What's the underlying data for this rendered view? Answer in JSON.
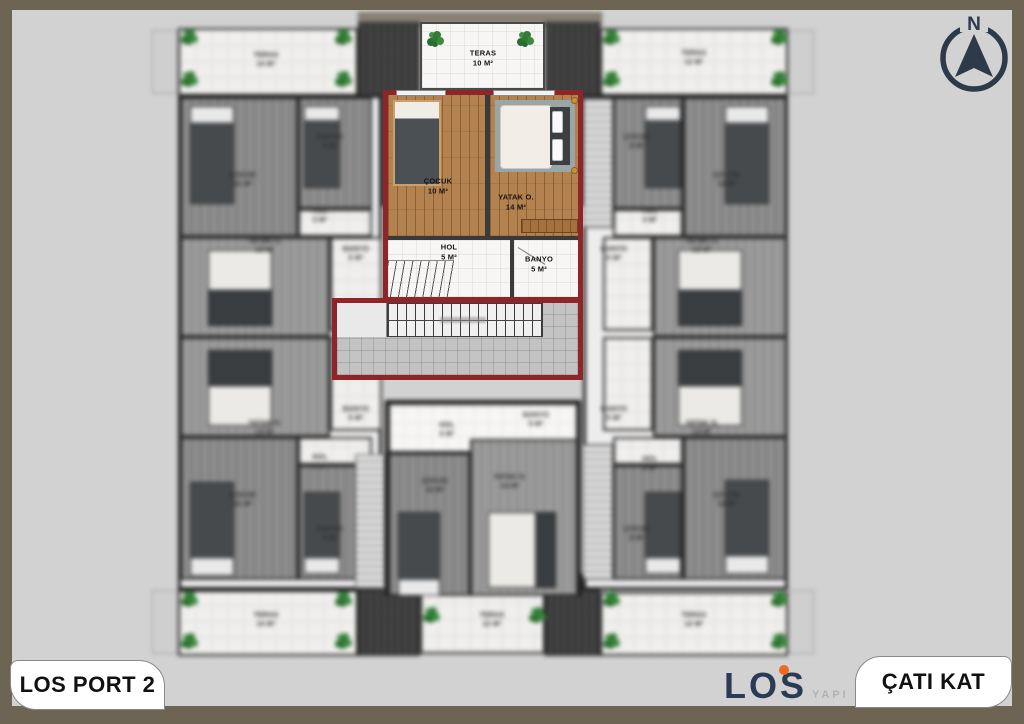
{
  "colors": {
    "frame": "#6e6453",
    "canvas": "#d2d2d2",
    "focus_wall": "#8f2429",
    "accent_orange": "#f26a21",
    "logo_navy": "#2b3a55"
  },
  "titles": {
    "project": "LOS PORT 2",
    "floor": "ÇATI KAT"
  },
  "logo": {
    "name": "LOS",
    "suffix": "YAPI"
  },
  "compass": {
    "north": "N"
  },
  "focused_unit": {
    "teras": {
      "name": "TERAS",
      "area": "10 M²"
    },
    "cocuk": {
      "name": "ÇOCUK",
      "area": "10 M²"
    },
    "yatak": {
      "name": "YATAK O.",
      "area": "14 M²"
    },
    "hol": {
      "name": "HOL",
      "area": "5 M²"
    },
    "banyo": {
      "name": "BANYO",
      "area": "5 M²"
    }
  },
  "units": {
    "top_left": {
      "teras": {
        "name": "TERAS",
        "area": "14 M²"
      },
      "cocuk_big": {
        "name": "ÇOCUK",
        "area": "12 M²"
      },
      "cocuk_small": {
        "name": "ÇOCUK",
        "area": "9 M²"
      },
      "hol": {
        "name": "HOL",
        "area": "3 M²"
      },
      "yatak": {
        "name": "YATAK O.",
        "area": "13 M²"
      },
      "banyo": {
        "name": "BANYO",
        "area": "5 M²"
      }
    },
    "bottom_left": {
      "teras": {
        "name": "TERAS",
        "area": "14 M²"
      },
      "cocuk_big": {
        "name": "ÇOCUK",
        "area": "12 M²"
      },
      "cocuk_small": {
        "name": "ÇOCUK",
        "area": "9 M²"
      },
      "hol": {
        "name": "HOL",
        "area": "3 M²"
      },
      "yatak": {
        "name": "YATAK O.",
        "area": "13 M²"
      },
      "banyo": {
        "name": "BANYO",
        "area": "5 M²"
      }
    },
    "top_right": {
      "teras": {
        "name": "TERAS",
        "area": "12 M²"
      },
      "cocuk_big": {
        "name": "ÇOCUK",
        "area": "12 M²"
      },
      "cocuk_small": {
        "name": "ÇOCUK",
        "area": "9 M²"
      },
      "hol": {
        "name": "HOL",
        "area": "3 M²"
      },
      "yatak": {
        "name": "YATAK O.",
        "area": "13 M²"
      },
      "banyo": {
        "name": "BANYO",
        "area": "5 M²"
      }
    },
    "bottom_right": {
      "teras": {
        "name": "TERAS",
        "area": "12 M²"
      },
      "cocuk_big": {
        "name": "ÇOCUK",
        "area": "12 M²"
      },
      "cocuk_small": {
        "name": "ÇOCUK",
        "area": "9 M²"
      },
      "hol": {
        "name": "HOL",
        "area": "3 M²"
      },
      "yatak": {
        "name": "YATAK O.",
        "area": "13 M²"
      },
      "banyo": {
        "name": "BANYO",
        "area": "5 M²"
      }
    },
    "bottom_center": {
      "teras": {
        "name": "TERAS",
        "area": "12 M²"
      },
      "cocuk": {
        "name": "ÇOCUK",
        "area": "10 M²"
      },
      "yatak": {
        "name": "YATAK O.",
        "area": "14 M²"
      },
      "hol": {
        "name": "HOL",
        "area": "5 M²"
      },
      "banyo": {
        "name": "BANYO",
        "area": "5 M²"
      }
    }
  }
}
